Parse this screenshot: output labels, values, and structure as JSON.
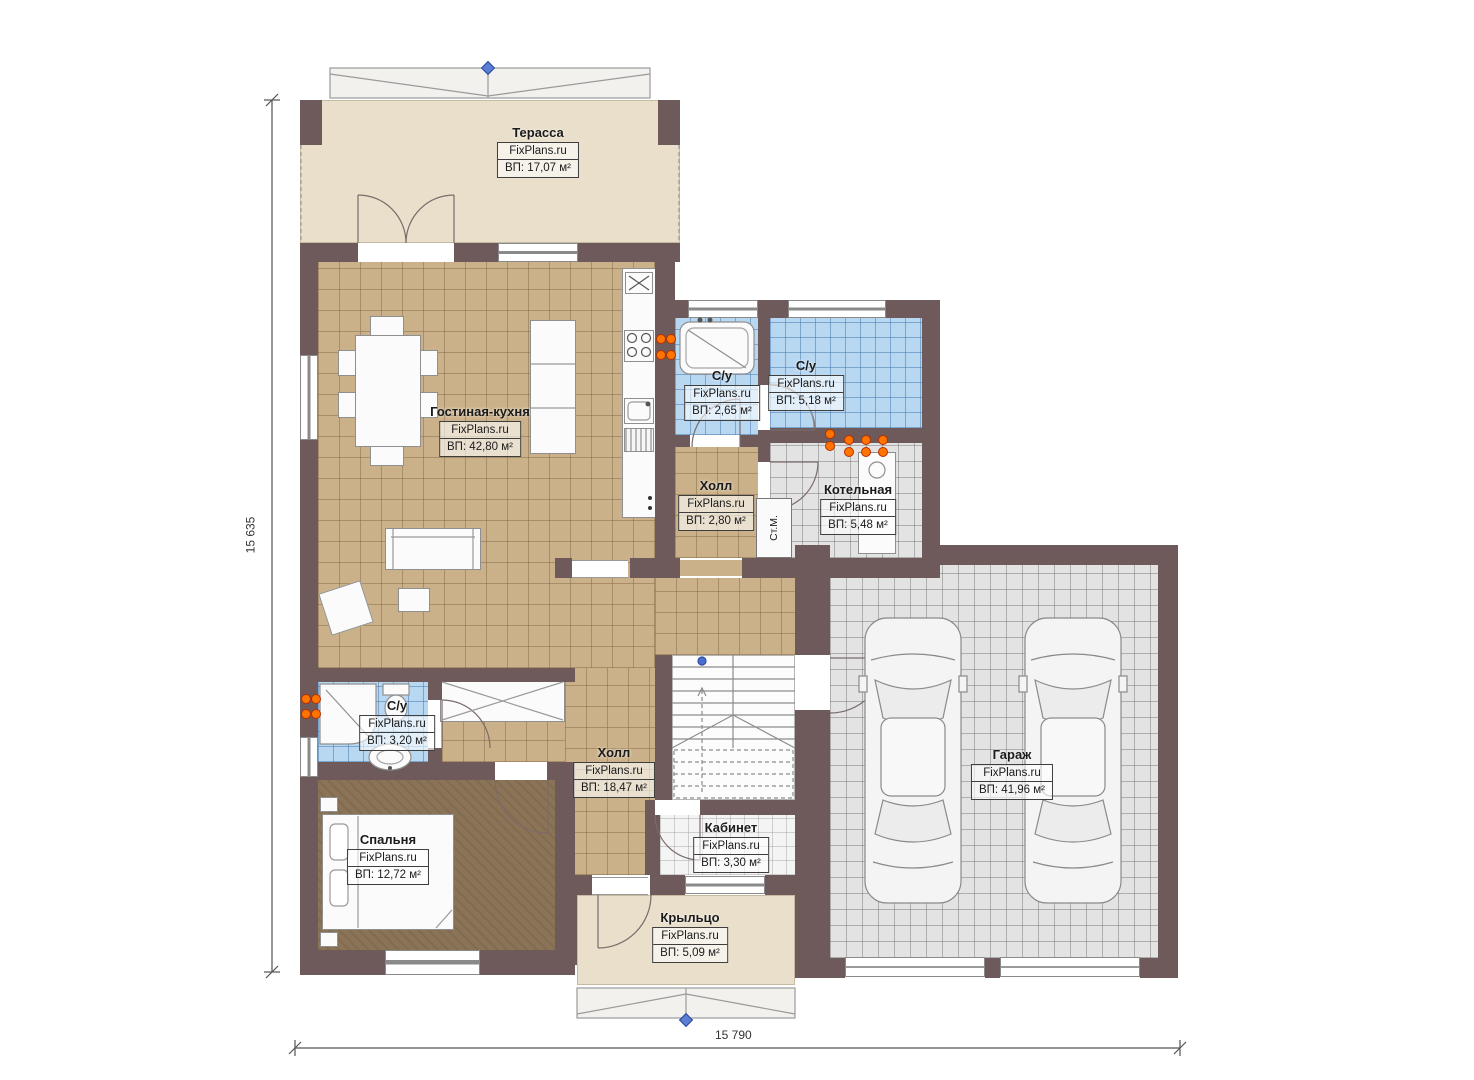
{
  "watermark": "FixPlans.ru",
  "dimensions": {
    "height_label": "15 635",
    "width_label": "15 790"
  },
  "appliances": {
    "washing_machine": "Ст.М."
  },
  "rooms": [
    {
      "id": "terrace",
      "name": "Терасса",
      "area": "ВП: 17,07 м²"
    },
    {
      "id": "living-kitchen",
      "name": "Гостиная-кухня",
      "area": "ВП: 42,80 м²"
    },
    {
      "id": "bathroom-1",
      "name": "С/у",
      "area": "ВП: 2,65 м²"
    },
    {
      "id": "bathroom-2",
      "name": "С/у",
      "area": "ВП: 5,18 м²"
    },
    {
      "id": "hall-small",
      "name": "Холл",
      "area": "ВП: 2,80 м²"
    },
    {
      "id": "boiler-room",
      "name": "Котельная",
      "area": "ВП: 5,48 м²"
    },
    {
      "id": "bathroom-3",
      "name": "С/у",
      "area": "ВП: 3,20 м²"
    },
    {
      "id": "hall-main",
      "name": "Холл",
      "area": "ВП: 18,47 м²"
    },
    {
      "id": "bedroom",
      "name": "Спальня",
      "area": "ВП: 12,72 м²"
    },
    {
      "id": "cabinet",
      "name": "Кабинет",
      "area": "ВП: 3,30 м²"
    },
    {
      "id": "garage",
      "name": "Гараж",
      "area": "ВП: 41,96 м²"
    },
    {
      "id": "porch",
      "name": "Крыльцо",
      "area": "ВП: 5,09 м²"
    }
  ]
}
